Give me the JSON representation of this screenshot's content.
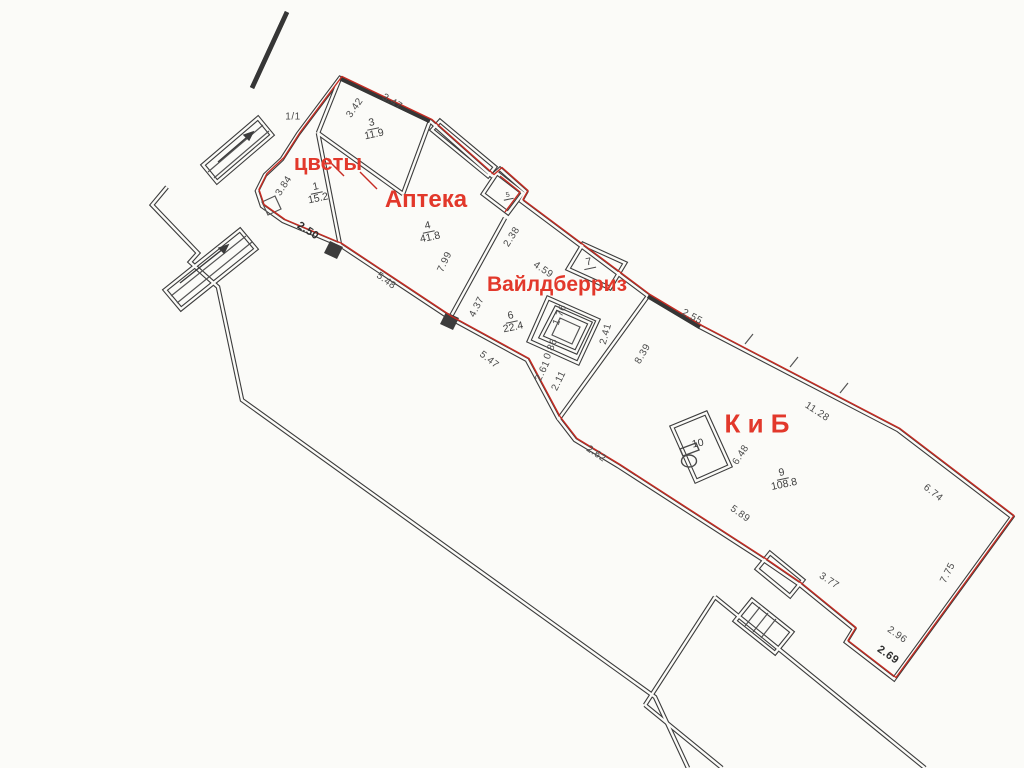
{
  "drawing": {
    "type": "floor-plan",
    "colors": {
      "paper": "#fbfbf8",
      "walls": "#3c3c3c",
      "lease_outline_red": "#c62b22",
      "shop_label_red": "#e2382b",
      "dimension_text": "#4a4a4a"
    }
  },
  "shops": {
    "flowers": "цветы",
    "pharmacy": "Аптека",
    "wildberries": "Вайлдберриз",
    "kib": "К и Б"
  },
  "rooms": [
    {
      "number": "1",
      "area": "15.2"
    },
    {
      "number": "3",
      "area": "11.9"
    },
    {
      "number": "4",
      "area": "41.8"
    },
    {
      "number": "5",
      "area": ""
    },
    {
      "number": "6",
      "area": "22.4"
    },
    {
      "number": "7",
      "area": ""
    },
    {
      "number": "9",
      "area": "108.8"
    },
    {
      "number": "10",
      "area": ""
    }
  ],
  "dims": {
    "axis": "1/1",
    "room3_left": "3.42",
    "room3_top": "3.47",
    "room1_left": "3.84",
    "room1_bottom": "2.50",
    "room4_bottom": "5.48",
    "room4_height": "7.99",
    "room5_wall": "2.38",
    "room6_top": "4.59",
    "room4_right": "4.37",
    "room6_bottom": "5.47",
    "shaft_1": "1.76",
    "shaft_2": "0.86",
    "shaft_3": "2.61",
    "shaft_4": "2.11",
    "shaft_5": "2.41",
    "kib_left": "8.39",
    "kib_top_1": "2.55",
    "kib_top_2": "11.28",
    "kib_top_3": "6.74",
    "kib_right": "7.75",
    "kib_corner_1": "2.96",
    "kib_corner_2": "2.69",
    "kib_bottom": "5.89",
    "room10_wall": "6.48",
    "kib_step": "2.62",
    "kib_notch": "3.77"
  }
}
